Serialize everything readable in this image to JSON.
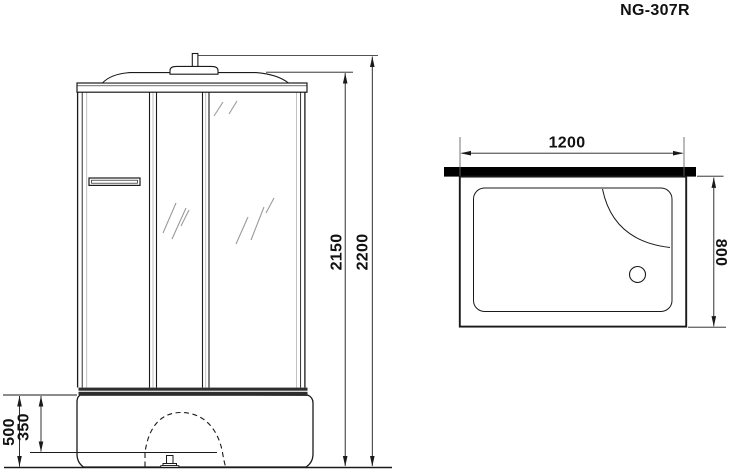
{
  "title": "NG-307R",
  "front_view": {
    "dim_total_height": "2200",
    "dim_cabin_height": "2150",
    "dim_base_height": "500",
    "dim_tray_rim_height": "350"
  },
  "plan_view": {
    "dim_width": "1200",
    "dim_depth": "800"
  },
  "colors": {
    "line": "#1a1a1a",
    "back_wall_panel": "#000000",
    "frame_band": "#2e2e2e",
    "glass_mark": "#9b9b9b",
    "background": "#ffffff"
  }
}
